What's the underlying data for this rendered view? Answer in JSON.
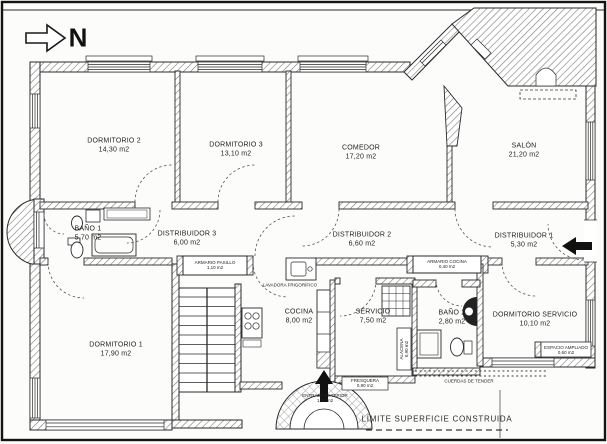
{
  "compass": {
    "north": "N"
  },
  "rooms": [
    {
      "name": "DORMITORIO 2",
      "area": "14,30 m2"
    },
    {
      "name": "DORMITORIO 3",
      "area": "13,10 m2"
    },
    {
      "name": "COMEDOR",
      "area": "17,20 m2"
    },
    {
      "name": "SALÓN",
      "area": "21,20 m2"
    },
    {
      "name": "BAÑO 1",
      "area": "5,70 m2"
    },
    {
      "name": "DISTRIBUIDOR 3",
      "area": "6,00 m2"
    },
    {
      "name": "DISTRIBUIDOR 2",
      "area": "6,60 m2"
    },
    {
      "name": "DISTRIBUIDOR 1",
      "area": "5,30 m2"
    },
    {
      "name": "DORMITORIO 1",
      "area": "17,90 m2"
    },
    {
      "name": "COCINA",
      "area": "8,00 m2"
    },
    {
      "name": "SERVICIO",
      "area": "7,50 m2"
    },
    {
      "name": "BAÑO 2",
      "area": "2,80 m2"
    },
    {
      "name": "DORMITORIO SERVICIO",
      "area": "10,10 m2"
    }
  ],
  "storage": [
    {
      "name": "ARMARIO PASILLO",
      "area": "1,10 m2"
    },
    {
      "name": "ARMARIO COCINA",
      "area": "0,40 m2"
    },
    {
      "name": "ALACENA",
      "area": "0,90 m2"
    },
    {
      "name": "FRESQUERA",
      "area": "0,90 m2"
    },
    {
      "name": "ENTRADA EXTERIOR",
      "area": "1,00 m2"
    },
    {
      "name": "ESPACIO AMPLIADO",
      "area": "0,60 m2"
    },
    {
      "name": "LAVADORA FRIGORÍFICO",
      "area": ""
    }
  ],
  "annotations": {
    "clotheslines": "CUERDAS DE TENDER",
    "built_limit": "LÍMITE SUPERFICIE CONSTRUIDA"
  },
  "colors": {
    "ink": "#1c1c1c",
    "paper": "#fcfcfb"
  }
}
